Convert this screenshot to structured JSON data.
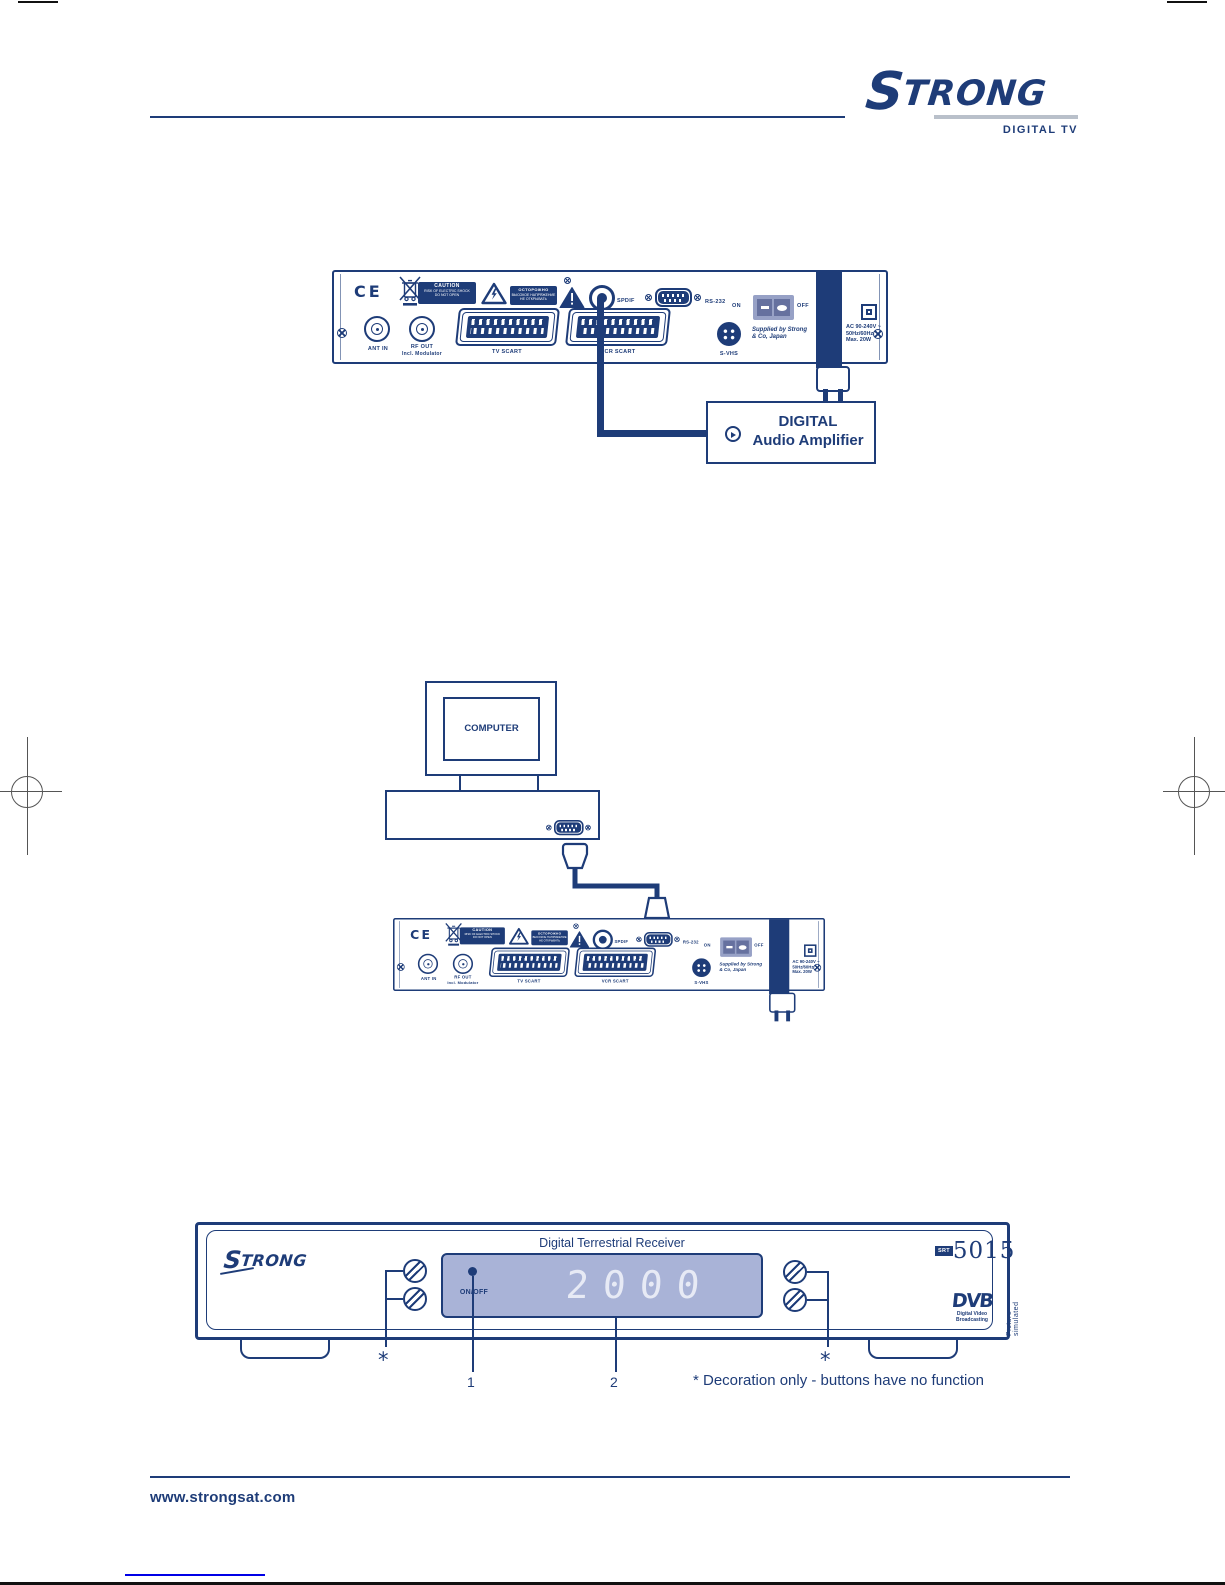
{
  "header": {
    "brand": "STRONG",
    "tagline": "DIGITAL TV"
  },
  "rear_panel": {
    "ce_mark": "CE",
    "caution_label": {
      "title": "CAUTION",
      "line1": "RISK OF ELECTRIC SHOCK",
      "line2": "DO NOT OPEN"
    },
    "caution_label_2": {
      "title": "ОСТОРОЖНО",
      "line1": "ВЫСОКОЕ НАПРЯЖЕНИЕ",
      "line2": "НЕ ОТКРЫВАТЬ"
    },
    "connectors": {
      "ant_in": "ANT IN",
      "rf_out_line1": "RF OUT",
      "rf_out_line2": "Incl. Modulator",
      "tv_scart": "TV SCART",
      "vcr_scart": "VCR SCART",
      "spdif": "SPDIF",
      "rs232": "RS-232",
      "svhs": "S-VHS"
    },
    "power": {
      "on": "ON",
      "off": "OFF",
      "supplier_line1": "Supplied by Strong",
      "supplier_line2": "& Co, Japan",
      "rating_line1": "AC  90-240V ~",
      "rating_line2": "50Hz/60Hz",
      "rating_line3": "Max. 20W"
    },
    "icons": {
      "weee": "crossed-out-wheelie-bin",
      "warning_shock": "lightning-warning-triangle",
      "warning_general": "exclamation-warning-triangle",
      "double_insulation": "square-in-square"
    }
  },
  "audio_diagram": {
    "amplifier_line1": "DIGITAL",
    "amplifier_line2": "Audio Amplifier"
  },
  "computer_diagram": {
    "monitor_label": "COMPUTER"
  },
  "front_panel": {
    "brand": "STRONG",
    "title": "Digital Terrestrial Receiver",
    "model_prefix": "SRT",
    "model_number": "5015",
    "display_value": "2000",
    "on_off_label": "ON/OFF",
    "dvb_logo": "DVB",
    "dvb_sub1": "Digital Video",
    "dvb_sub2": "Broadcasting",
    "picture_simulated": "Picture simulated",
    "callout_star_left": "*",
    "callout_1": "1",
    "callout_2": "2",
    "callout_star_right": "*",
    "footnote": "* Decoration only - buttons have no function"
  },
  "footer": {
    "website": "www.strongsat.com"
  },
  "colors": {
    "navy": "#1e3c78",
    "display_bg": "#a9b3d7",
    "digits": "#e7eaf5",
    "silver": "#b9c0ca",
    "link_blue": "#0000e6"
  }
}
